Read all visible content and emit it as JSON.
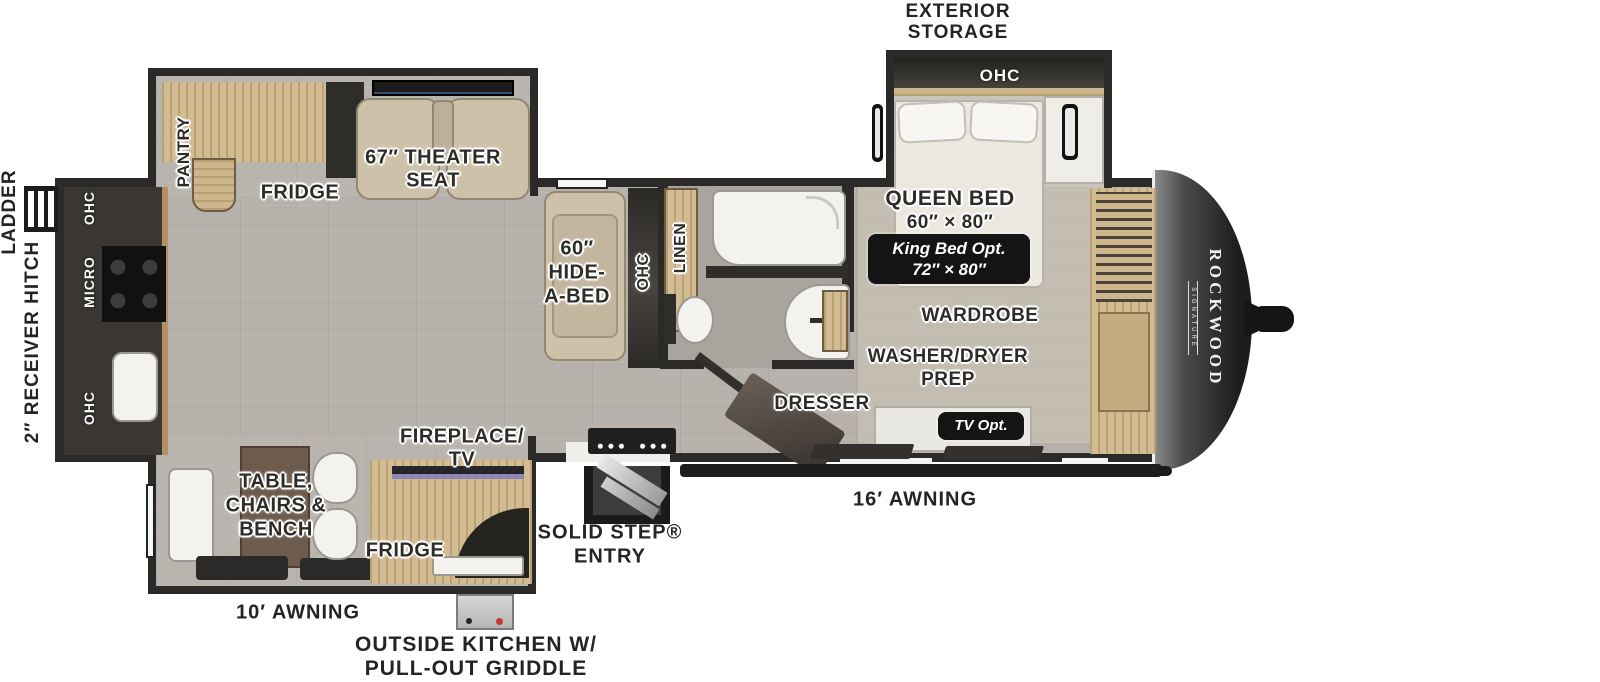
{
  "brand": {
    "name": "ROCKWOOD",
    "series": "SIGNATURE"
  },
  "colors": {
    "wall": "#2b2a28",
    "floor": "#b6b2ab",
    "wood": "#d3bb92",
    "fabric": "#cdc1aa",
    "badge_bg": "#141414",
    "front_cap": "#1d1d1d"
  },
  "exterior": {
    "exterior_storage": [
      "EXTERIOR",
      "STORAGE"
    ],
    "ladder": "LADDER",
    "receiver_hitch": "2″ RECEIVER HITCH",
    "awning_main": "16′ AWNING",
    "awning_rear": "10′ AWNING",
    "outside_kitchen": [
      "OUTSIDE KITCHEN W/",
      "PULL-OUT GRIDDLE"
    ],
    "entry": [
      "SOLID STEP®",
      "ENTRY"
    ]
  },
  "bedroom": {
    "ohc": "OHC",
    "queen_bed": [
      "QUEEN BED",
      "60″ × 80″"
    ],
    "king_bed_opt": [
      "King Bed Opt.",
      "72″ × 80″"
    ],
    "wardrobe": "WARDROBE",
    "washer_dryer": [
      "WASHER/DRYER",
      "PREP"
    ],
    "dresser": "DRESSER",
    "tv_opt": "TV Opt."
  },
  "bathroom": {
    "linen": "LINEN"
  },
  "living": {
    "pantry": "PANTRY",
    "fridge": "FRIDGE",
    "theater_seat": [
      "67″ THEATER",
      "SEAT"
    ],
    "hide_a_bed": [
      "60″",
      "HIDE-",
      "A-BED"
    ],
    "ohc_sofa": "OHC",
    "fireplace_tv": [
      "FIREPLACE/",
      "TV"
    ],
    "dinette": [
      "TABLE,",
      "CHAIRS &",
      "BENCH"
    ],
    "fridge_outside": "FRIDGE"
  },
  "kitchen": {
    "ohc_top": "OHC",
    "micro": "MICRO",
    "ohc_bottom": "OHC"
  }
}
